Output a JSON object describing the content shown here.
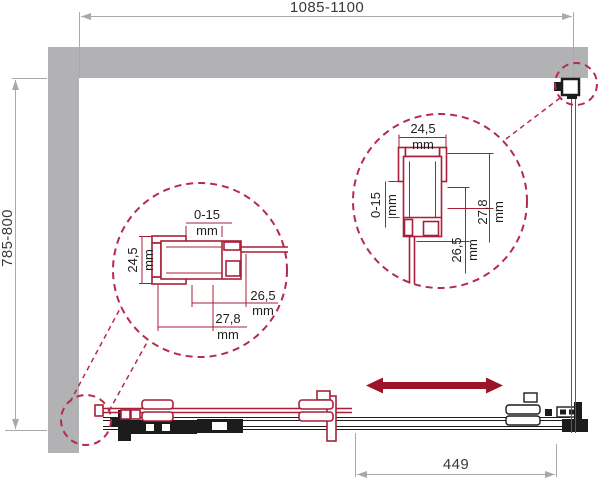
{
  "colors": {
    "wall": "#b2b2b4",
    "red": "#a81f38",
    "arrow": "#9c1428",
    "dashred": "#b52b4c",
    "blk": "#1c1c1c",
    "dim": "#a9a9a9",
    "text": "#3a3a3a",
    "glass": "#5a5a5a"
  },
  "dimensions": {
    "width": "1085-1100",
    "height": "785-800",
    "travel": "449"
  },
  "detail_left": {
    "adjustment": "0-15",
    "height": "24,5",
    "depth_inner": "26,5",
    "depth_outer": "27,8",
    "unit": "mm"
  },
  "detail_right": {
    "adjustment": "0-15",
    "width": "24,5",
    "depth_inner": "26,5",
    "depth_outer": "27,8",
    "unit": "mm"
  }
}
